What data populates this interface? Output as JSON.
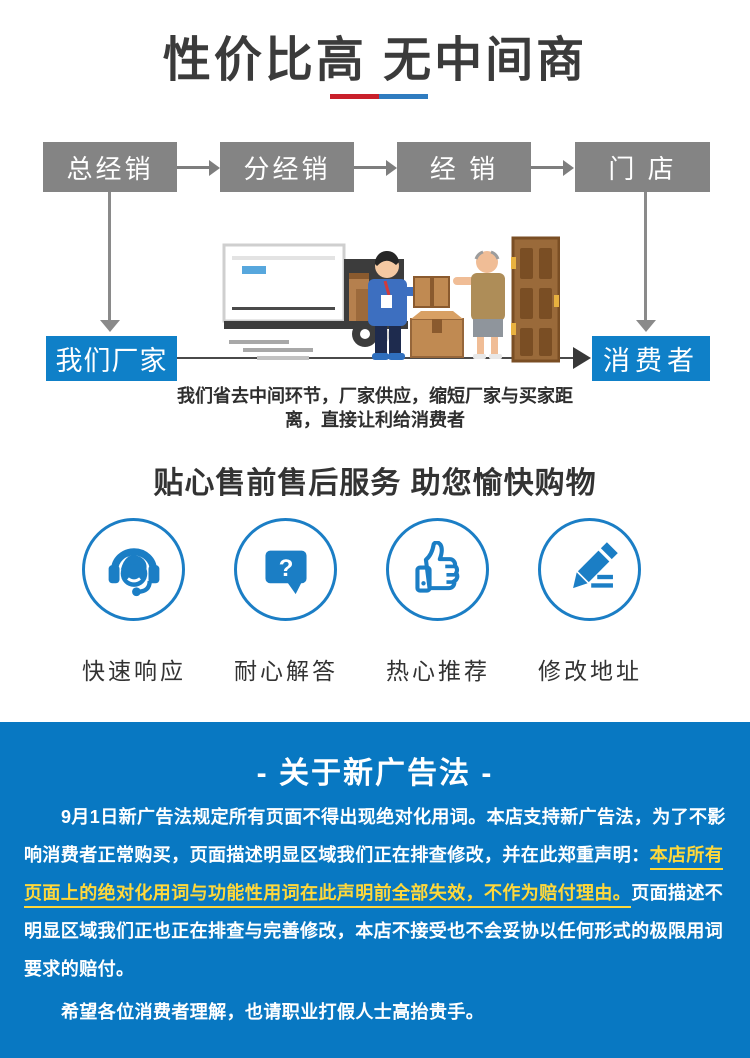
{
  "colors": {
    "accent_blue": "#0878c2",
    "box_blue": "#0f80c8",
    "box_gray": "#848484",
    "highlight_yellow": "#ffd83b",
    "divider_red": "#c9202b",
    "divider_blue": "#2f7cc0"
  },
  "header": {
    "title": "性价比高 无中间商"
  },
  "flow": {
    "boxes": [
      {
        "label": "总经销"
      },
      {
        "label": "分经销"
      },
      {
        "label": "经 销"
      },
      {
        "label": "门 店"
      }
    ],
    "factory": {
      "label": "我们厂家"
    },
    "consumer": {
      "label": "消费者"
    },
    "caption": {
      "line1": "我们省去中间环节，厂家供应，缩短厂家与买家距",
      "line2": "离，直接让利给消费者"
    },
    "illustration": "delivery-truck-courier-customer-door"
  },
  "services": {
    "title": "贴心售前售后服务 助您愉快购物",
    "items": [
      {
        "icon": "headset-icon",
        "label": "快速响应"
      },
      {
        "icon": "question-bubble-icon",
        "label": "耐心解答"
      },
      {
        "icon": "thumb-up-icon",
        "label": "热心推荐"
      },
      {
        "icon": "pencil-icon",
        "label": "修改地址"
      }
    ]
  },
  "notice": {
    "title": "- 关于新广告法 -",
    "lines": [
      {
        "segments": [
          {
            "text": "9月1日新广告法规定所有页面不得出现绝对化用词。本店支持新广告法，为了不影"
          }
        ]
      },
      {
        "segments": [
          {
            "text": "响消费者正常购买，页面描述明显区域我们正在排查修改，并在此郑重声明："
          },
          {
            "text": "本店所有",
            "highlight": true
          }
        ]
      },
      {
        "segments": [
          {
            "text": "页面上的绝对化用词与功能性用词在此声明前全部失效，不作为赔付理由。",
            "highlight": true
          },
          {
            "text": "页面描述不"
          }
        ]
      },
      {
        "segments": [
          {
            "text": "明显区域我们正也正在排查与完善修改，本店不接受也不会妥协以任何形式的极限用词"
          }
        ]
      },
      {
        "segments": [
          {
            "text": "要求的赔付。"
          }
        ]
      },
      {
        "segments": [
          {
            "text": "希望各位消费者理解，也请职业打假人士高抬贵手。"
          }
        ]
      }
    ]
  }
}
